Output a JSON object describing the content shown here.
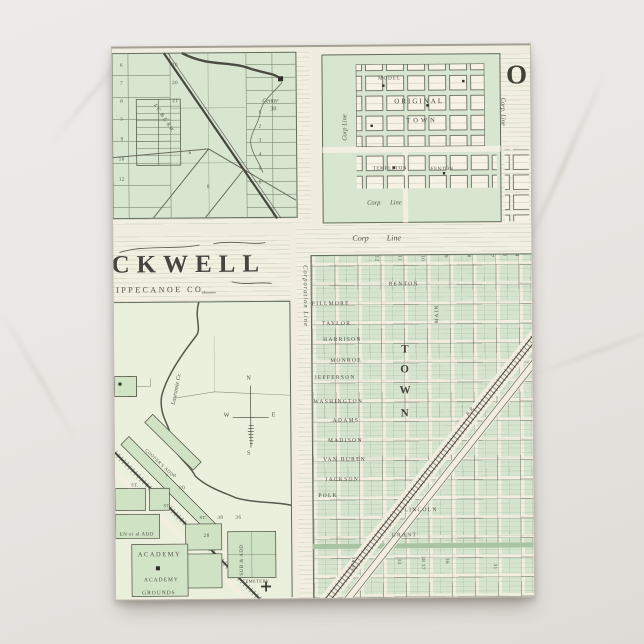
{
  "card": {
    "nw": {
      "rr_label": "I. C. & L. R.W.",
      "center": "Center",
      "center_num": "30",
      "nums": [
        "20",
        "20",
        "21",
        "8",
        "7",
        "6",
        "5",
        "9",
        "10",
        "12",
        "6",
        "8",
        "1",
        "2",
        "3",
        "4",
        "5",
        "6"
      ]
    },
    "ne": {
      "big_letter": "O",
      "model": "MODEL",
      "original": "ORIGINAL",
      "town": "TOWN",
      "templeton": "TEMPLETON",
      "fenton": "FENTON",
      "corp_left": "Corp Line",
      "corp_bottom": "Corp Line",
      "corp_right": "Corp. Line"
    },
    "sw": {
      "title": "CKWELL",
      "county": "TIPPECANOE CO.",
      "creek": "Lauramie Cr.",
      "compass_n": "N",
      "compass_s": "S",
      "compass_e": "E",
      "compass_w": "W",
      "academy_upper": "ACADEMY",
      "academy_lower": "ACADEMY",
      "grounds": "GROUNDS",
      "add_left": "EN et al ADD",
      "add_diag": "COOPER'S ADD",
      "add_vert": "SUB & ADD",
      "cemetery": "CEMETERY",
      "st_label": "ST.",
      "nums": [
        "30",
        "36",
        "20",
        "7",
        "8",
        "28"
      ]
    },
    "se": {
      "corp_top": "Corp Line",
      "corp_left": "Corporation Line",
      "streets": [
        "BENTON",
        "FILLMORE",
        "TAYLOR",
        "HARRISON",
        "MONROE",
        "JEFFERSON",
        "WASHINGTON",
        "ADAMS",
        "MADISON",
        "VAN BUREN",
        "JACKSON",
        "POLK",
        "LINCOLN",
        "GRANT"
      ],
      "big_vertical": [
        "T",
        "O",
        "W",
        "N"
      ],
      "top_nums": [
        "12",
        "11",
        "10",
        "9",
        "8",
        "7"
      ],
      "side_nums": [
        "5",
        "4"
      ],
      "bottom_nums": [
        "34 35",
        "33",
        "38 37",
        "36",
        "31"
      ],
      "vert_street": "MAIN",
      "rr_label": "R. R."
    },
    "colors": {
      "marble": "#e9e6e3",
      "paper": "#f0edde",
      "map_green": "#d6e4cd",
      "ink": "#4a4c41"
    }
  }
}
